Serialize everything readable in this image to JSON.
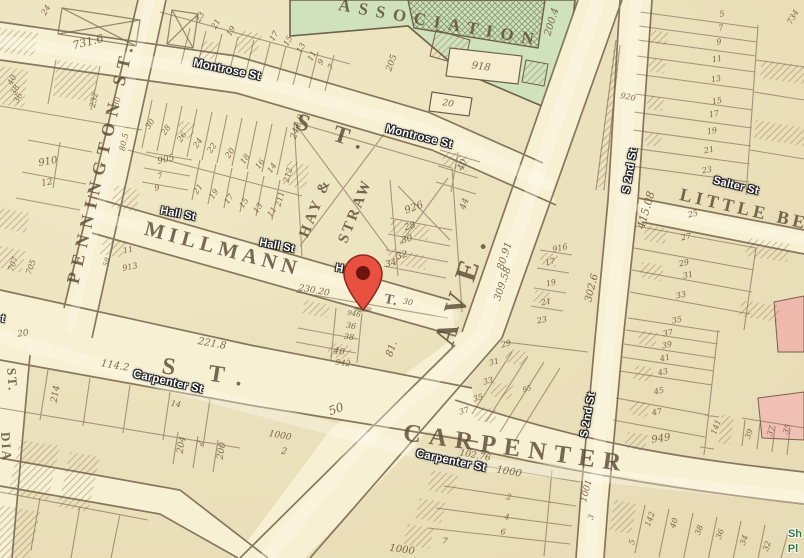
{
  "map": {
    "pin": {
      "x": 363,
      "y": 310,
      "color_body": "#e8503f",
      "color_stroke": "#8e2a1c",
      "color_hole": "#6d140c"
    },
    "colors": {
      "paper": "#ebe1bc",
      "road": "#f7f0d3",
      "map_line": "#74614a",
      "green_block": "#cfe2bb",
      "pink_block": "#efb9ad",
      "modern_label": "#ffffff",
      "green_label": "#35793b",
      "old_text": "#5c4b35",
      "number_text": "#6a5538"
    },
    "modern_labels": [
      {
        "id": "montrose-st-1",
        "t": "Montrose St",
        "x": 227,
        "y": 70,
        "r": 12,
        "s": 11.5
      },
      {
        "id": "montrose-st-2",
        "t": "Montrose St",
        "x": 419,
        "y": 137,
        "r": 14,
        "s": 11.5
      },
      {
        "id": "hall-st-1",
        "t": "Hall St",
        "x": 178,
        "y": 214,
        "r": 11,
        "s": 11
      },
      {
        "id": "hall-st-2",
        "t": "Hall St",
        "x": 277,
        "y": 246,
        "r": 11,
        "s": 11
      },
      {
        "id": "hall-st-3",
        "t": "Hall St",
        "x": 353,
        "y": 271,
        "r": 10,
        "s": 11
      },
      {
        "id": "s-2nd-st-1",
        "t": "S 2nd St",
        "x": 630,
        "y": 171,
        "r": -80,
        "s": 11
      },
      {
        "id": "s-2nd-st-2",
        "t": "S 2nd St",
        "x": 588,
        "y": 415,
        "r": -80,
        "s": 11
      },
      {
        "id": "salter-st",
        "t": "Salter St",
        "x": 736,
        "y": 186,
        "r": 14,
        "s": 11
      },
      {
        "id": "carpenter-st-1",
        "t": "Carpenter St",
        "x": 168,
        "y": 382,
        "r": 13,
        "s": 11.5
      },
      {
        "id": "carpenter-st-2",
        "t": "Carpenter St",
        "x": 451,
        "y": 461,
        "r": 12,
        "s": 11.5
      },
      {
        "id": "left-edge-partial",
        "t": "t",
        "x": 3,
        "y": 319,
        "r": 10,
        "s": 11
      }
    ],
    "green_labels": [
      {
        "id": "green-poi-line1",
        "t": "Sh",
        "x": 795,
        "y": 534,
        "s": 11
      },
      {
        "id": "green-poi-line2",
        "t": "Pl",
        "x": 793,
        "y": 549,
        "s": 11
      }
    ],
    "old_names": [
      {
        "id": "association",
        "t": "ASSOCIATION",
        "x": 440,
        "y": 23,
        "r": 10,
        "s": 17,
        "ls": 8
      },
      {
        "id": "montrose-old-st",
        "t": "S T.",
        "x": 334,
        "y": 134,
        "r": 18,
        "s": 24,
        "ls": 10
      },
      {
        "id": "millmann",
        "t": "MILLMANN",
        "x": 223,
        "y": 249,
        "r": 15,
        "s": 21,
        "ls": 5
      },
      {
        "id": "millmann-st-end",
        "t": "T.",
        "x": 391,
        "y": 301,
        "r": 12,
        "s": 14,
        "ls": 1
      },
      {
        "id": "pennington-st",
        "t": "PENNINGTON ST.",
        "x": 101,
        "y": 162,
        "r": -77,
        "s": 18,
        "ls": 7
      },
      {
        "id": "hay",
        "t": "HAY &",
        "x": 316,
        "y": 208,
        "r": -68,
        "s": 15,
        "ls": 3
      },
      {
        "id": "straw",
        "t": "STRAW",
        "x": 356,
        "y": 211,
        "r": -68,
        "s": 15,
        "ls": 3
      },
      {
        "id": "ave",
        "t": "AVE.",
        "x": 463,
        "y": 286,
        "r": -72,
        "s": 30,
        "ls": 14
      },
      {
        "id": "carpenter-west-st",
        "t": "S T.",
        "x": 209,
        "y": 374,
        "r": 9,
        "s": 24,
        "ls": 14
      },
      {
        "id": "carpenter-old",
        "t": "CARPENTER",
        "x": 516,
        "y": 449,
        "r": 8,
        "s": 25,
        "ls": 8
      },
      {
        "id": "little-bel",
        "t": "LITTLE BEL",
        "x": 752,
        "y": 211,
        "r": 13,
        "s": 18,
        "ls": 4
      },
      {
        "id": "left-old-st",
        "t": "ST.",
        "x": 12,
        "y": 380,
        "r": 86,
        "s": 13,
        "ls": 2
      },
      {
        "id": "left-old-dia",
        "t": "DIA",
        "x": 6,
        "y": 447,
        "r": 86,
        "s": 13,
        "ls": 2
      }
    ],
    "numbers": [
      {
        "t": "731.6",
        "x": 88,
        "y": 42,
        "r": -14,
        "s": 11
      },
      {
        "t": "24",
        "x": 46,
        "y": 10,
        "r": -60,
        "s": 8
      },
      {
        "t": "40",
        "x": 12,
        "y": 80,
        "r": -62,
        "s": 8
      },
      {
        "t": "38",
        "x": 15,
        "y": 90,
        "r": -62,
        "s": 8
      },
      {
        "t": "36",
        "x": 18,
        "y": 98,
        "r": -62,
        "s": 8
      },
      {
        "t": "232",
        "x": 94,
        "y": 100,
        "r": -78,
        "s": 8
      },
      {
        "t": "30",
        "x": 117,
        "y": 102,
        "r": -75,
        "s": 8
      },
      {
        "t": "80.5",
        "x": 124,
        "y": 142,
        "r": -78,
        "s": 8
      },
      {
        "t": "910",
        "x": 48,
        "y": 162,
        "r": -10,
        "s": 10
      },
      {
        "t": "12",
        "x": 47,
        "y": 183,
        "r": -10,
        "s": 9
      },
      {
        "t": "707",
        "x": 13,
        "y": 264,
        "r": -70,
        "s": 8
      },
      {
        "t": "705",
        "x": 31,
        "y": 267,
        "r": -70,
        "s": 8
      },
      {
        "t": "905",
        "x": 166,
        "y": 160,
        "r": -12,
        "s": 9
      },
      {
        "t": "7",
        "x": 160,
        "y": 176,
        "r": -12,
        "s": 8
      },
      {
        "t": "9",
        "x": 157,
        "y": 188,
        "r": -12,
        "s": 8
      },
      {
        "t": "11",
        "x": 128,
        "y": 250,
        "r": -12,
        "s": 8
      },
      {
        "t": "913",
        "x": 130,
        "y": 267,
        "r": -12,
        "s": 8
      },
      {
        "t": "58",
        "x": 107,
        "y": 262,
        "r": -75,
        "s": 7
      },
      {
        "t": "23",
        "x": 200,
        "y": 17,
        "r": -60,
        "s": 8
      },
      {
        "t": "21",
        "x": 216,
        "y": 24,
        "r": -60,
        "s": 8
      },
      {
        "t": "19",
        "x": 231,
        "y": 31,
        "r": -60,
        "s": 8
      },
      {
        "t": "17",
        "x": 274,
        "y": 36,
        "r": -60,
        "s": 8
      },
      {
        "t": "15",
        "x": 288,
        "y": 41,
        "r": -60,
        "s": 8
      },
      {
        "t": "13",
        "x": 301,
        "y": 48,
        "r": -60,
        "s": 8
      },
      {
        "t": "11",
        "x": 312,
        "y": 56,
        "r": -60,
        "s": 8
      },
      {
        "t": "9",
        "x": 321,
        "y": 62,
        "r": -60,
        "s": 8
      },
      {
        "t": "7",
        "x": 331,
        "y": 67,
        "r": -60,
        "s": 8
      },
      {
        "t": "205",
        "x": 392,
        "y": 63,
        "r": -70,
        "s": 9
      },
      {
        "t": "918",
        "x": 481,
        "y": 67,
        "r": 8,
        "s": 10
      },
      {
        "t": "20",
        "x": 448,
        "y": 104,
        "r": 8,
        "s": 9
      },
      {
        "t": "200.4",
        "x": 552,
        "y": 22,
        "r": -73,
        "s": 10
      },
      {
        "t": "920",
        "x": 628,
        "y": 97,
        "r": 12,
        "s": 8
      },
      {
        "t": "734",
        "x": 793,
        "y": 17,
        "r": -60,
        "s": 8
      },
      {
        "t": "5",
        "x": 722,
        "y": 14,
        "r": -10,
        "s": 8
      },
      {
        "t": "7",
        "x": 721,
        "y": 28,
        "r": -10,
        "s": 8
      },
      {
        "t": "9",
        "x": 719,
        "y": 42,
        "r": -10,
        "s": 8
      },
      {
        "t": "11",
        "x": 717,
        "y": 59,
        "r": -10,
        "s": 8
      },
      {
        "t": "13",
        "x": 716,
        "y": 79,
        "r": -10,
        "s": 8
      },
      {
        "t": "15",
        "x": 717,
        "y": 101,
        "r": -10,
        "s": 8
      },
      {
        "t": "17",
        "x": 714,
        "y": 114,
        "r": -10,
        "s": 8
      },
      {
        "t": "19",
        "x": 712,
        "y": 131,
        "r": -10,
        "s": 8
      },
      {
        "t": "21",
        "x": 709,
        "y": 150,
        "r": -10,
        "s": 8
      },
      {
        "t": "23",
        "x": 707,
        "y": 170,
        "r": -10,
        "s": 8
      },
      {
        "t": "30",
        "x": 150,
        "y": 124,
        "r": -55,
        "s": 8
      },
      {
        "t": "28",
        "x": 166,
        "y": 130,
        "r": -55,
        "s": 8
      },
      {
        "t": "26",
        "x": 182,
        "y": 137,
        "r": -55,
        "s": 8
      },
      {
        "t": "24",
        "x": 198,
        "y": 143,
        "r": -55,
        "s": 8
      },
      {
        "t": "22",
        "x": 212,
        "y": 148,
        "r": -55,
        "s": 8
      },
      {
        "t": "20",
        "x": 230,
        "y": 153,
        "r": -55,
        "s": 8
      },
      {
        "t": "18",
        "x": 245,
        "y": 159,
        "r": -55,
        "s": 8
      },
      {
        "t": "16",
        "x": 260,
        "y": 164,
        "r": -55,
        "s": 8
      },
      {
        "t": "14",
        "x": 272,
        "y": 168,
        "r": -55,
        "s": 8
      },
      {
        "t": "212",
        "x": 288,
        "y": 175,
        "r": -75,
        "s": 8
      },
      {
        "t": "211",
        "x": 280,
        "y": 199,
        "r": -75,
        "s": 8
      },
      {
        "t": "241.9",
        "x": 298,
        "y": 127,
        "r": -70,
        "s": 9
      },
      {
        "t": "21",
        "x": 198,
        "y": 189,
        "r": -55,
        "s": 8
      },
      {
        "t": "19",
        "x": 214,
        "y": 194,
        "r": -55,
        "s": 8
      },
      {
        "t": "17",
        "x": 229,
        "y": 199,
        "r": -55,
        "s": 8
      },
      {
        "t": "15",
        "x": 244,
        "y": 203,
        "r": -55,
        "s": 8
      },
      {
        "t": "13",
        "x": 258,
        "y": 208,
        "r": -55,
        "s": 8
      },
      {
        "t": "11",
        "x": 272,
        "y": 212,
        "r": -55,
        "s": 8
      },
      {
        "t": "926",
        "x": 414,
        "y": 208,
        "r": -20,
        "s": 10
      },
      {
        "t": "28",
        "x": 410,
        "y": 227,
        "r": -15,
        "s": 9
      },
      {
        "t": "30",
        "x": 407,
        "y": 240,
        "r": -15,
        "s": 9
      },
      {
        "t": "32",
        "x": 402,
        "y": 256,
        "r": -15,
        "s": 9
      },
      {
        "t": "34",
        "x": 391,
        "y": 264,
        "r": -15,
        "s": 9
      },
      {
        "t": "40",
        "x": 463,
        "y": 165,
        "r": -70,
        "s": 9
      },
      {
        "t": "44",
        "x": 465,
        "y": 204,
        "r": -70,
        "s": 9
      },
      {
        "t": "80.91",
        "x": 505,
        "y": 256,
        "r": -72,
        "s": 10
      },
      {
        "t": "309.58",
        "x": 503,
        "y": 284,
        "r": -72,
        "s": 10
      },
      {
        "t": "415.08",
        "x": 646,
        "y": 210,
        "r": -74,
        "s": 11
      },
      {
        "t": "302.6",
        "x": 592,
        "y": 288,
        "r": -76,
        "s": 10
      },
      {
        "t": "916",
        "x": 560,
        "y": 248,
        "r": -12,
        "s": 8
      },
      {
        "t": "17",
        "x": 550,
        "y": 262,
        "r": -12,
        "s": 8
      },
      {
        "t": "19",
        "x": 551,
        "y": 283,
        "r": -12,
        "s": 8
      },
      {
        "t": "21",
        "x": 546,
        "y": 302,
        "r": -12,
        "s": 8
      },
      {
        "t": "23",
        "x": 542,
        "y": 320,
        "r": -12,
        "s": 8
      },
      {
        "t": "25",
        "x": 693,
        "y": 214,
        "r": -12,
        "s": 8
      },
      {
        "t": "27",
        "x": 686,
        "y": 237,
        "r": -12,
        "s": 8
      },
      {
        "t": "29",
        "x": 684,
        "y": 263,
        "r": -12,
        "s": 8
      },
      {
        "t": "31",
        "x": 688,
        "y": 275,
        "r": -12,
        "s": 8
      },
      {
        "t": "33",
        "x": 681,
        "y": 295,
        "r": -12,
        "s": 8
      },
      {
        "t": "35",
        "x": 677,
        "y": 320,
        "r": -12,
        "s": 8
      },
      {
        "t": "230.20",
        "x": 314,
        "y": 291,
        "r": 10,
        "s": 9
      },
      {
        "t": "30",
        "x": 408,
        "y": 302,
        "r": 10,
        "s": 8
      },
      {
        "t": "946",
        "x": 354,
        "y": 314,
        "r": 8,
        "s": 7
      },
      {
        "t": "36",
        "x": 351,
        "y": 326,
        "r": 8,
        "s": 8
      },
      {
        "t": "38",
        "x": 349,
        "y": 337,
        "r": 8,
        "s": 8
      },
      {
        "t": "40",
        "x": 339,
        "y": 352,
        "r": 8,
        "s": 9
      },
      {
        "t": "942",
        "x": 343,
        "y": 363,
        "r": 8,
        "s": 8
      },
      {
        "t": "81.",
        "x": 392,
        "y": 349,
        "r": -70,
        "s": 10
      },
      {
        "t": "50",
        "x": 336,
        "y": 409,
        "r": -20,
        "s": 12
      },
      {
        "t": "20",
        "x": 23,
        "y": 334,
        "r": -8,
        "s": 9
      },
      {
        "t": "221.8",
        "x": 212,
        "y": 344,
        "r": 10,
        "s": 10
      },
      {
        "t": "114.2",
        "x": 115,
        "y": 366,
        "r": 10,
        "s": 10
      },
      {
        "t": "214",
        "x": 56,
        "y": 394,
        "r": -80,
        "s": 9
      },
      {
        "t": "14",
        "x": 176,
        "y": 404,
        "r": 10,
        "s": 8
      },
      {
        "t": "204",
        "x": 182,
        "y": 445,
        "r": -80,
        "s": 9
      },
      {
        "t": "2",
        "x": 200,
        "y": 443,
        "r": -70,
        "s": 8
      },
      {
        "t": "200",
        "x": 222,
        "y": 451,
        "r": -80,
        "s": 9
      },
      {
        "t": "1000",
        "x": 280,
        "y": 436,
        "r": 10,
        "s": 9
      },
      {
        "t": "2",
        "x": 284,
        "y": 452,
        "r": 10,
        "s": 9
      },
      {
        "t": "29",
        "x": 506,
        "y": 344,
        "r": -15,
        "s": 8
      },
      {
        "t": "31",
        "x": 494,
        "y": 362,
        "r": -15,
        "s": 8
      },
      {
        "t": "33",
        "x": 488,
        "y": 381,
        "r": -15,
        "s": 8
      },
      {
        "t": "35",
        "x": 478,
        "y": 398,
        "r": -15,
        "s": 8
      },
      {
        "t": "37",
        "x": 464,
        "y": 411,
        "r": -15,
        "s": 8
      },
      {
        "t": "95",
        "x": 527,
        "y": 389,
        "r": -15,
        "s": 7
      },
      {
        "t": "102.76",
        "x": 475,
        "y": 456,
        "r": 10,
        "s": 9
      },
      {
        "t": "1000",
        "x": 509,
        "y": 472,
        "r": 10,
        "s": 10
      },
      {
        "t": "2",
        "x": 509,
        "y": 497,
        "r": 8,
        "s": 8
      },
      {
        "t": "4",
        "x": 507,
        "y": 517,
        "r": 8,
        "s": 8
      },
      {
        "t": "6",
        "x": 503,
        "y": 532,
        "r": 8,
        "s": 8
      },
      {
        "t": "7",
        "x": 445,
        "y": 541,
        "r": 8,
        "s": 8
      },
      {
        "t": "1001",
        "x": 587,
        "y": 491,
        "r": -75,
        "s": 9
      },
      {
        "t": "3",
        "x": 591,
        "y": 517,
        "r": -75,
        "s": 8
      },
      {
        "t": "1000",
        "x": 402,
        "y": 550,
        "r": 8,
        "s": 10
      },
      {
        "t": "37",
        "x": 668,
        "y": 333,
        "r": -12,
        "s": 8
      },
      {
        "t": "39",
        "x": 667,
        "y": 345,
        "r": -12,
        "s": 8
      },
      {
        "t": "41",
        "x": 665,
        "y": 358,
        "r": -12,
        "s": 8
      },
      {
        "t": "43",
        "x": 663,
        "y": 372,
        "r": -12,
        "s": 8
      },
      {
        "t": "45",
        "x": 659,
        "y": 391,
        "r": -12,
        "s": 8
      },
      {
        "t": "47",
        "x": 657,
        "y": 412,
        "r": -12,
        "s": 8
      },
      {
        "t": "949",
        "x": 661,
        "y": 439,
        "r": -8,
        "s": 10
      },
      {
        "t": "141",
        "x": 716,
        "y": 427,
        "r": -70,
        "s": 8
      },
      {
        "t": "39",
        "x": 749,
        "y": 434,
        "r": -70,
        "s": 8
      },
      {
        "t": "37",
        "x": 771,
        "y": 431,
        "r": -70,
        "s": 8
      },
      {
        "t": "35",
        "x": 787,
        "y": 429,
        "r": -70,
        "s": 8
      },
      {
        "t": "142",
        "x": 650,
        "y": 519,
        "r": -70,
        "s": 8
      },
      {
        "t": "40",
        "x": 674,
        "y": 523,
        "r": -70,
        "s": 8
      },
      {
        "t": "38",
        "x": 699,
        "y": 530,
        "r": -70,
        "s": 8
      },
      {
        "t": "36",
        "x": 720,
        "y": 534,
        "r": -70,
        "s": 8
      },
      {
        "t": "34",
        "x": 744,
        "y": 540,
        "r": -70,
        "s": 8
      },
      {
        "t": "32",
        "x": 767,
        "y": 546,
        "r": -70,
        "s": 8
      },
      {
        "t": "5",
        "x": 632,
        "y": 542,
        "r": -70,
        "s": 8
      }
    ]
  }
}
